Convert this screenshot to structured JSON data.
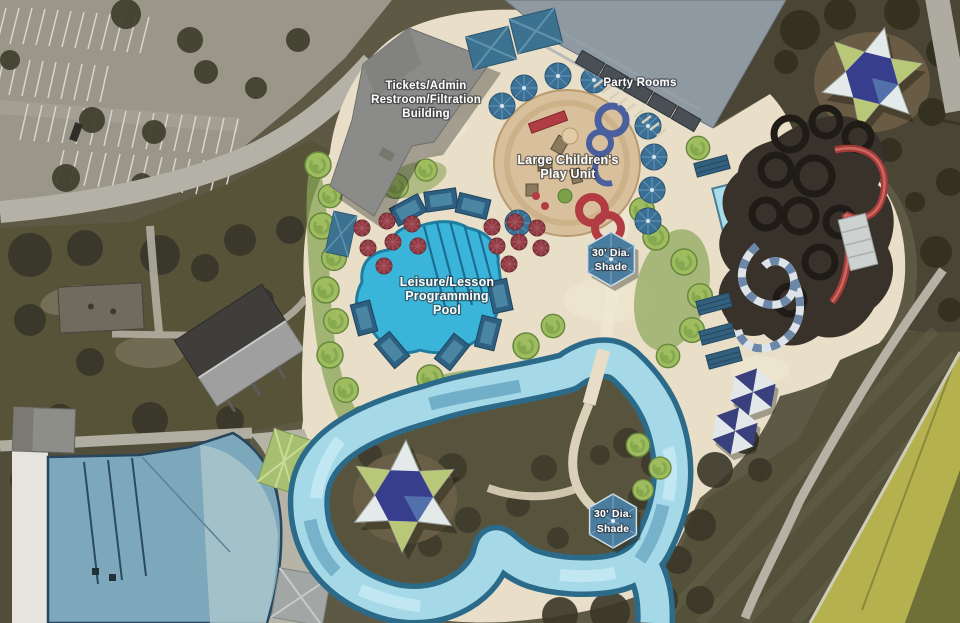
{
  "labels": {
    "tickets_admin": {
      "line1": "Tickets/Admin",
      "line2": "Restroom/Filtration",
      "line3": "Building"
    },
    "party_rooms": "Party Rooms",
    "play_unit": {
      "line1": "Large Children's",
      "line2": "Play Unit"
    },
    "shade_upper": {
      "line1": "30' Dia.",
      "line2": "Shade"
    },
    "shade_lower": {
      "line1": "30' Dia.",
      "line2": "Shade"
    },
    "leisure_pool": {
      "line1": "Leisure/Lesson",
      "line2": "Programming",
      "line3": "Pool"
    }
  },
  "palette": {
    "deck": "#e9dfc9",
    "leisure_pool_water": "#3ab5d9",
    "lazy_river_water": "#a6d9e8",
    "river_edge": "#2c6a8a",
    "existing_pool_water": "#7da8bc",
    "parking_asphalt": "#9a978a",
    "field_grass": "#54513b",
    "ticket_roof_gray": "#8b8b89",
    "party_roof_gray": "#8e99a2",
    "umbrella_blue": "#3c6f94",
    "shade_navy": "#3a3f7e",
    "canopy_green": "#a6bf70",
    "play_sand": "#d9c09c",
    "slide_red": "#a83a3a",
    "table_red": "#8e3a42",
    "road_yellow": "#b5b14f",
    "label_text": "#ffffff"
  }
}
